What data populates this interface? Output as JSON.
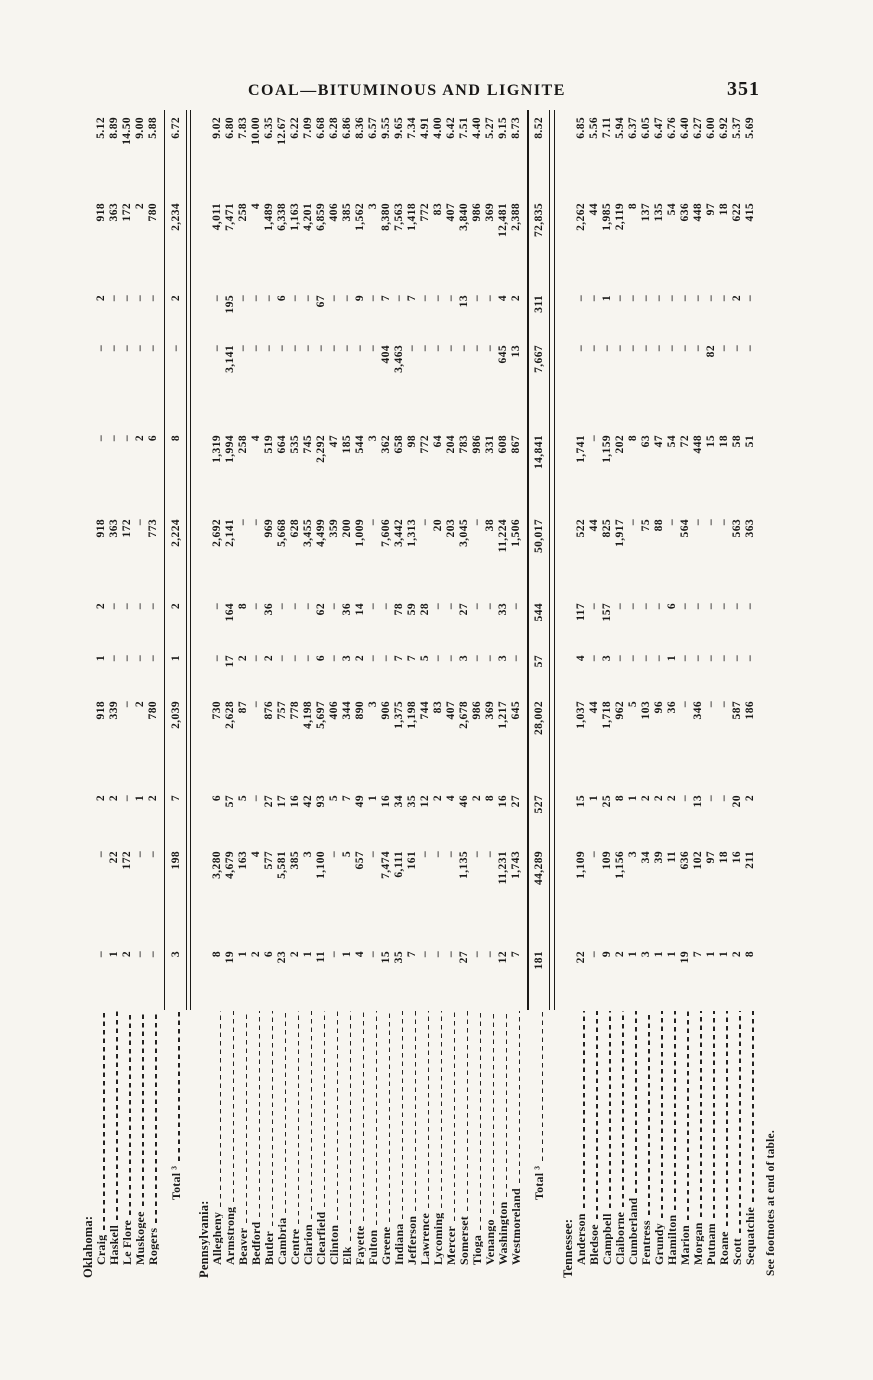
{
  "page": {
    "running_title": "COAL—BITUMINOUS AND LIGNITE",
    "page_number": "351",
    "footnote": "See footnotes at end of table."
  },
  "table": {
    "empty_marker": "–",
    "groups": [
      {
        "state": "Oklahoma:",
        "rows": [
          {
            "label": "Craig",
            "values": [
              "–",
              "–",
              "2",
              "918",
              "1",
              "2",
              "918",
              "–",
              "–",
              "2",
              "918",
              "5.12"
            ]
          },
          {
            "label": "Haskell",
            "values": [
              "1",
              "22",
              "2",
              "339",
              "–",
              "–",
              "363",
              "–",
              "–",
              "–",
              "363",
              "8.89"
            ]
          },
          {
            "label": "Le Flore",
            "values": [
              "2",
              "172",
              "–",
              "–",
              "–",
              "–",
              "172",
              "–",
              "–",
              "–",
              "172",
              "14.50"
            ]
          },
          {
            "label": "Muskogee",
            "values": [
              "–",
              "–",
              "1",
              "2",
              "–",
              "–",
              "–",
              "2",
              "–",
              "–",
              "2",
              "9.00"
            ]
          },
          {
            "label": "Rogers",
            "values": [
              "–",
              "–",
              "2",
              "780",
              "–",
              "–",
              "773",
              "6",
              "–",
              "–",
              "780",
              "5.88"
            ]
          }
        ],
        "total": {
          "label": "Total ³",
          "values": [
            "3",
            "198",
            "7",
            "2,039",
            "1",
            "2",
            "2,224",
            "8",
            "–",
            "2",
            "2,234",
            "6.72"
          ]
        }
      },
      {
        "state": "Pennsylvania:",
        "rows": [
          {
            "label": "Allegheny",
            "values": [
              "8",
              "3,280",
              "6",
              "730",
              "–",
              "–",
              "2,692",
              "1,319",
              "–",
              "–",
              "4,011",
              "9.02"
            ]
          },
          {
            "label": "Armstrong",
            "values": [
              "19",
              "4,679",
              "57",
              "2,628",
              "17",
              "164",
              "2,141",
              "1,994",
              "3,141",
              "195",
              "7,471",
              "6.80"
            ]
          },
          {
            "label": "Beaver",
            "values": [
              "1",
              "163",
              "5",
              "87",
              "2",
              "8",
              "–",
              "258",
              "–",
              "–",
              "258",
              "7.83"
            ]
          },
          {
            "label": "Bedford",
            "values": [
              "2",
              "4",
              "–",
              "–",
              "–",
              "–",
              "–",
              "4",
              "–",
              "–",
              "4",
              "10.00"
            ]
          },
          {
            "label": "Butler",
            "values": [
              "6",
              "577",
              "27",
              "876",
              "2",
              "36",
              "969",
              "519",
              "–",
              "–",
              "1,489",
              "6.35"
            ]
          },
          {
            "label": "Cambria",
            "values": [
              "23",
              "5,581",
              "17",
              "757",
              "–",
              "–",
              "5,668",
              "664",
              "–",
              "6",
              "6,338",
              "12.67"
            ]
          },
          {
            "label": "Centre",
            "values": [
              "2",
              "385",
              "16",
              "778",
              "–",
              "–",
              "628",
              "535",
              "–",
              "–",
              "1,163",
              "6.22"
            ]
          },
          {
            "label": "Clarion",
            "values": [
              "1",
              "3",
              "42",
              "4,198",
              "–",
              "–",
              "3,455",
              "745",
              "–",
              "–",
              "4,201",
              "7.09"
            ]
          },
          {
            "label": "Clearfield",
            "values": [
              "11",
              "1,100",
              "93",
              "5,697",
              "6",
              "62",
              "4,499",
              "2,292",
              "–",
              "67",
              "6,859",
              "6.68"
            ]
          },
          {
            "label": "Clinton",
            "values": [
              "–",
              "–",
              "5",
              "406",
              "–",
              "–",
              "359",
              "47",
              "–",
              "–",
              "406",
              "6.28"
            ]
          },
          {
            "label": "Elk",
            "values": [
              "1",
              "5",
              "7",
              "344",
              "3",
              "36",
              "200",
              "185",
              "–",
              "–",
              "385",
              "6.86"
            ]
          },
          {
            "label": "Fayette",
            "values": [
              "4",
              "657",
              "49",
              "890",
              "2",
              "14",
              "1,009",
              "544",
              "–",
              "9",
              "1,562",
              "8.36"
            ]
          },
          {
            "label": "Fulton",
            "values": [
              "–",
              "–",
              "1",
              "3",
              "–",
              "–",
              "–",
              "3",
              "–",
              "–",
              "3",
              "6.57"
            ]
          },
          {
            "label": "Greene",
            "values": [
              "15",
              "7,474",
              "16",
              "906",
              "–",
              "–",
              "7,606",
              "362",
              "404",
              "7",
              "8,380",
              "9.55"
            ]
          },
          {
            "label": "Indiana",
            "values": [
              "35",
              "6,111",
              "34",
              "1,375",
              "7",
              "78",
              "3,442",
              "658",
              "3,463",
              "–",
              "7,563",
              "9.65"
            ]
          },
          {
            "label": "Jefferson",
            "values": [
              "7",
              "161",
              "35",
              "1,198",
              "7",
              "59",
              "1,313",
              "98",
              "–",
              "7",
              "1,418",
              "7.34"
            ]
          },
          {
            "label": "Lawrence",
            "values": [
              "–",
              "–",
              "12",
              "744",
              "5",
              "28",
              "–",
              "772",
              "–",
              "–",
              "772",
              "4.91"
            ]
          },
          {
            "label": "Lycoming",
            "values": [
              "–",
              "–",
              "2",
              "83",
              "–",
              "–",
              "20",
              "64",
              "–",
              "–",
              "83",
              "4.00"
            ]
          },
          {
            "label": "Mercer",
            "values": [
              "–",
              "–",
              "4",
              "407",
              "–",
              "–",
              "203",
              "204",
              "–",
              "–",
              "407",
              "6.42"
            ]
          },
          {
            "label": "Somerset",
            "values": [
              "27",
              "1,135",
              "46",
              "2,678",
              "3",
              "27",
              "3,045",
              "783",
              "–",
              "13",
              "3,840",
              "7.51"
            ]
          },
          {
            "label": "Tioga",
            "values": [
              "–",
              "–",
              "2",
              "986",
              "–",
              "–",
              "–",
              "986",
              "–",
              "–",
              "986",
              "4.40"
            ]
          },
          {
            "label": "Venango",
            "values": [
              "–",
              "–",
              "8",
              "369",
              "–",
              "–",
              "38",
              "331",
              "–",
              "–",
              "369",
              "5.27"
            ]
          },
          {
            "label": "Washington",
            "values": [
              "12",
              "11,231",
              "16",
              "1,217",
              "3",
              "33",
              "11,224",
              "608",
              "645",
              "4",
              "12,481",
              "9.15"
            ]
          },
          {
            "label": "Westmoreland",
            "values": [
              "7",
              "1,743",
              "27",
              "645",
              "–",
              "–",
              "1,506",
              "867",
              "13",
              "2",
              "2,388",
              "8.73"
            ]
          }
        ],
        "total": {
          "label": "Total ³",
          "values": [
            "181",
            "44,289",
            "527",
            "28,002",
            "57",
            "544",
            "50,017",
            "14,841",
            "7,667",
            "311",
            "72,835",
            "8.52"
          ]
        }
      },
      {
        "state": "Tennessee:",
        "rows": [
          {
            "label": "Anderson",
            "values": [
              "22",
              "1,109",
              "15",
              "1,037",
              "4",
              "117",
              "522",
              "1,741",
              "–",
              "–",
              "2,262",
              "6.85"
            ]
          },
          {
            "label": "Bledsoe",
            "values": [
              "–",
              "–",
              "1",
              "44",
              "–",
              "–",
              "44",
              "–",
              "–",
              "–",
              "44",
              "5.56"
            ]
          },
          {
            "label": "Campbell",
            "values": [
              "9",
              "109",
              "25",
              "1,718",
              "3",
              "157",
              "825",
              "1,159",
              "–",
              "1",
              "1,985",
              "7.11"
            ]
          },
          {
            "label": "Claiborne",
            "values": [
              "2",
              "1,156",
              "8",
              "962",
              "–",
              "–",
              "1,917",
              "202",
              "–",
              "–",
              "2,119",
              "5.94"
            ]
          },
          {
            "label": "Cumberland",
            "values": [
              "1",
              "3",
              "1",
              "5",
              "–",
              "–",
              "–",
              "8",
              "–",
              "–",
              "8",
              "6.37"
            ]
          },
          {
            "label": "Fentress",
            "values": [
              "3",
              "34",
              "2",
              "103",
              "–",
              "–",
              "75",
              "63",
              "–",
              "–",
              "137",
              "6.05"
            ]
          },
          {
            "label": "Grundy",
            "values": [
              "1",
              "39",
              "2",
              "96",
              "–",
              "–",
              "88",
              "47",
              "–",
              "–",
              "135",
              "6.47"
            ]
          },
          {
            "label": "Hamilton",
            "values": [
              "1",
              "11",
              "2",
              "36",
              "1",
              "6",
              "–",
              "54",
              "–",
              "–",
              "54",
              "6.76"
            ]
          },
          {
            "label": "Marion",
            "values": [
              "19",
              "636",
              "–",
              "–",
              "–",
              "–",
              "564",
              "72",
              "–",
              "–",
              "636",
              "6.40"
            ]
          },
          {
            "label": "Morgan",
            "values": [
              "7",
              "102",
              "13",
              "346",
              "–",
              "–",
              "–",
              "448",
              "–",
              "–",
              "448",
              "6.27"
            ]
          },
          {
            "label": "Putnam",
            "values": [
              "1",
              "97",
              "–",
              "–",
              "–",
              "–",
              "–",
              "15",
              "82",
              "–",
              "97",
              "6.00"
            ]
          },
          {
            "label": "Roane",
            "values": [
              "1",
              "18",
              "–",
              "–",
              "–",
              "–",
              "–",
              "18",
              "–",
              "–",
              "18",
              "6.92"
            ]
          },
          {
            "label": "Scott",
            "values": [
              "2",
              "16",
              "20",
              "587",
              "–",
              "–",
              "563",
              "58",
              "–",
              "2",
              "622",
              "5.37"
            ]
          },
          {
            "label": "Sequatchie",
            "values": [
              "8",
              "211",
              "2",
              "186",
              "–",
              "–",
              "363",
              "51",
              "–",
              "–",
              "415",
              "5.69"
            ]
          }
        ],
        "total": null
      }
    ]
  }
}
